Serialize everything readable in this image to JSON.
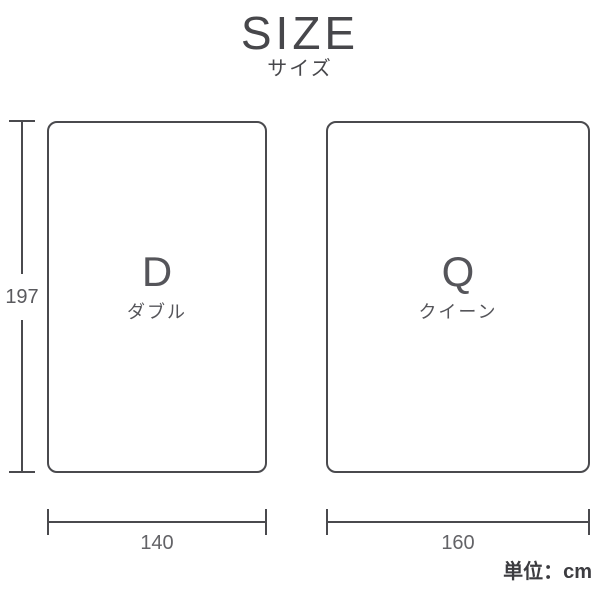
{
  "title": {
    "main": "SIZE",
    "sub": "サイズ"
  },
  "unit_label": "単位：cm",
  "height_dimension": {
    "value": "197"
  },
  "beds": [
    {
      "letter": "D",
      "name": "ダブル",
      "width": "140"
    },
    {
      "letter": "Q",
      "name": "クイーン",
      "width": "160"
    }
  ],
  "colors": {
    "line": "#4a4a4e",
    "heading": "#47474b",
    "bed_label": "#55555a",
    "dimension_text": "#636367",
    "unit_text": "#3c3c40",
    "background": "#ffffff"
  }
}
